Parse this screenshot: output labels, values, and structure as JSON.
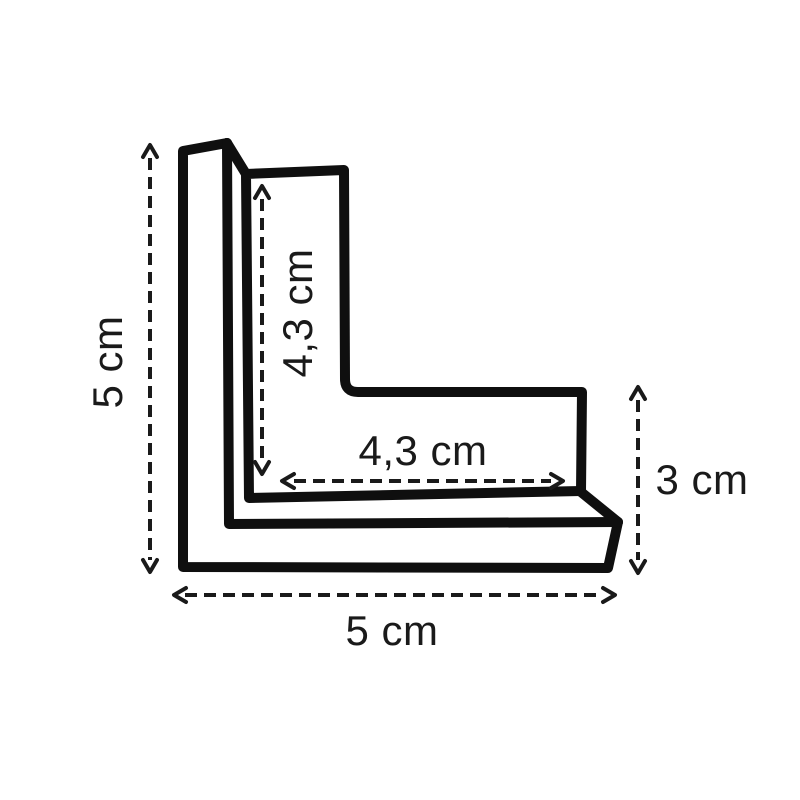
{
  "title": "L-shaped corner protector dimension diagram",
  "colors": {
    "background": "#ffffff",
    "shape_line": "#0f0f0f",
    "dimension_line": "#1a1a1a",
    "label_text": "#1a1a1a"
  },
  "dimensions": {
    "outer_height": {
      "label": "5 cm",
      "value_cm": 5,
      "orientation": "vertical-left"
    },
    "outer_width": {
      "label": "5 cm",
      "value_cm": 5,
      "orientation": "horizontal-bottom"
    },
    "inner_height": {
      "label": "4,3 cm",
      "value_cm": 4.3,
      "orientation": "vertical-inner"
    },
    "inner_width": {
      "label": "4,3 cm",
      "value_cm": 4.3,
      "orientation": "horizontal-inner"
    },
    "end_height": {
      "label": "3 cm",
      "value_cm": 3,
      "orientation": "vertical-right"
    }
  }
}
